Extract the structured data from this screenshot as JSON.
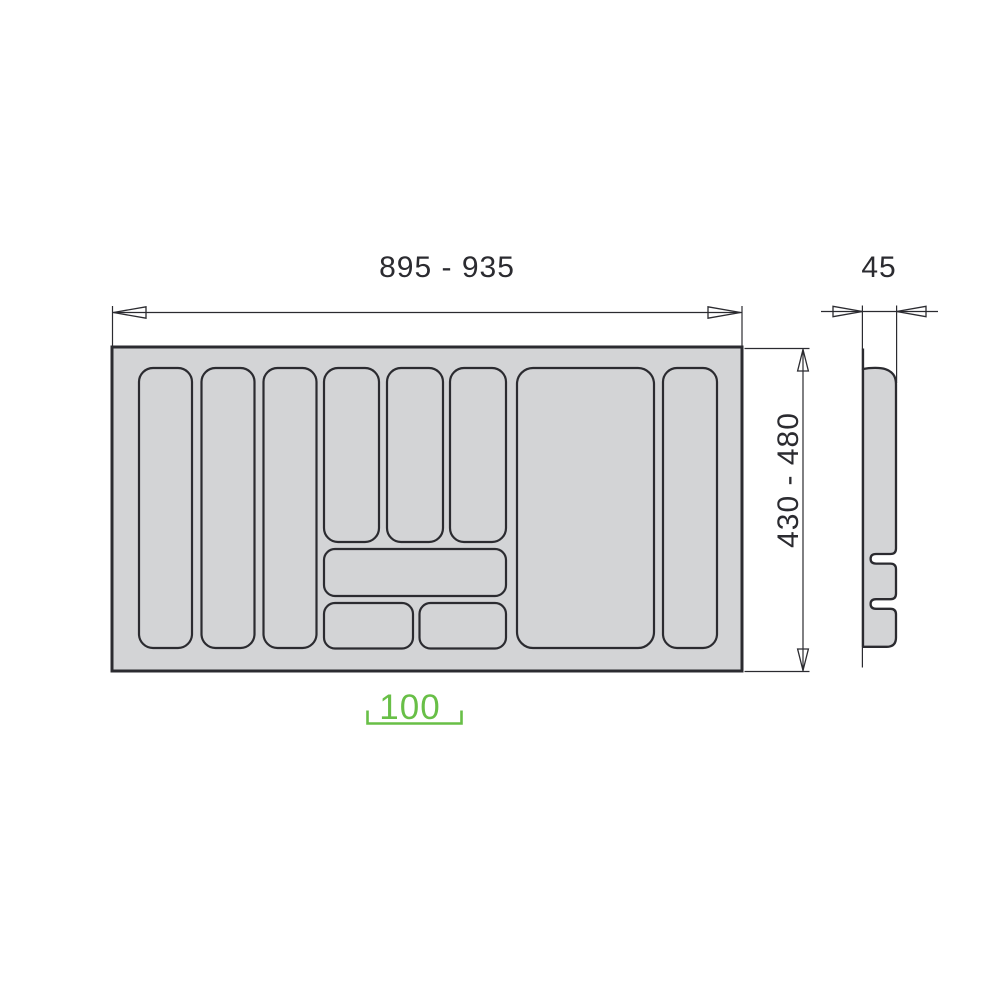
{
  "diagram": {
    "type": "furniture-technical-drawing",
    "subject": "cutlery tray drawer insert - top view with side cross-section profile",
    "labels": {
      "width_range": "895 - 935",
      "profile_depth": "45",
      "height_range": "430 - 480",
      "cabinet_size": "100"
    },
    "top_view": {
      "compartment_count": 11,
      "tall_compartments": 5,
      "medium_compartments": 3,
      "wide_compartment": 1,
      "small_compartments": 2
    },
    "colors": {
      "tray_fill": "#d3d4d6",
      "line": "#2b2b30",
      "accent_green": "#68bf47",
      "background": "#ffffff"
    }
  }
}
